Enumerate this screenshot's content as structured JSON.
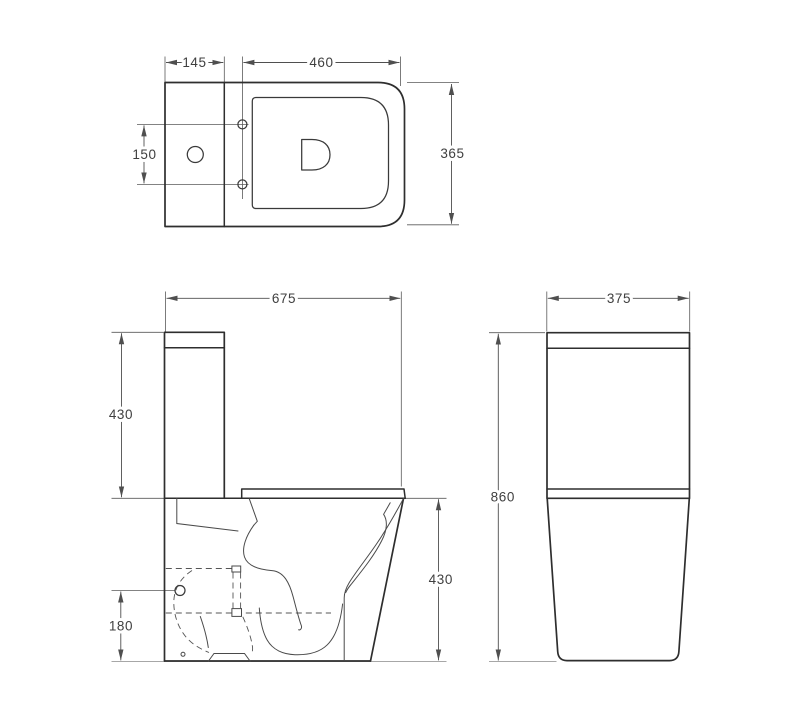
{
  "page": {
    "background": "#ffffff"
  },
  "drawing": {
    "type": "technical-drawing",
    "subject": "two-piece close-coupled toilet, dimensioned orthographic views",
    "unit": "mm",
    "colors": {
      "outline": "#2e2e2e",
      "detail": "#4a4a4a",
      "dimension": "#4f4f4f",
      "text": "#3f3f3f",
      "background": "#ffffff"
    },
    "views": {
      "top": {
        "label": "top view",
        "dims": {
          "tank_depth": "145",
          "seat_length": "460",
          "hinge_spacing": "150",
          "overall_width": "365"
        }
      },
      "side": {
        "label": "side view",
        "dims": {
          "overall_depth": "675",
          "tank_height": "430",
          "bowl_height": "430",
          "outlet_height": "180"
        }
      },
      "front": {
        "label": "front view",
        "dims": {
          "overall_width": "375",
          "overall_height": "860"
        }
      }
    }
  }
}
